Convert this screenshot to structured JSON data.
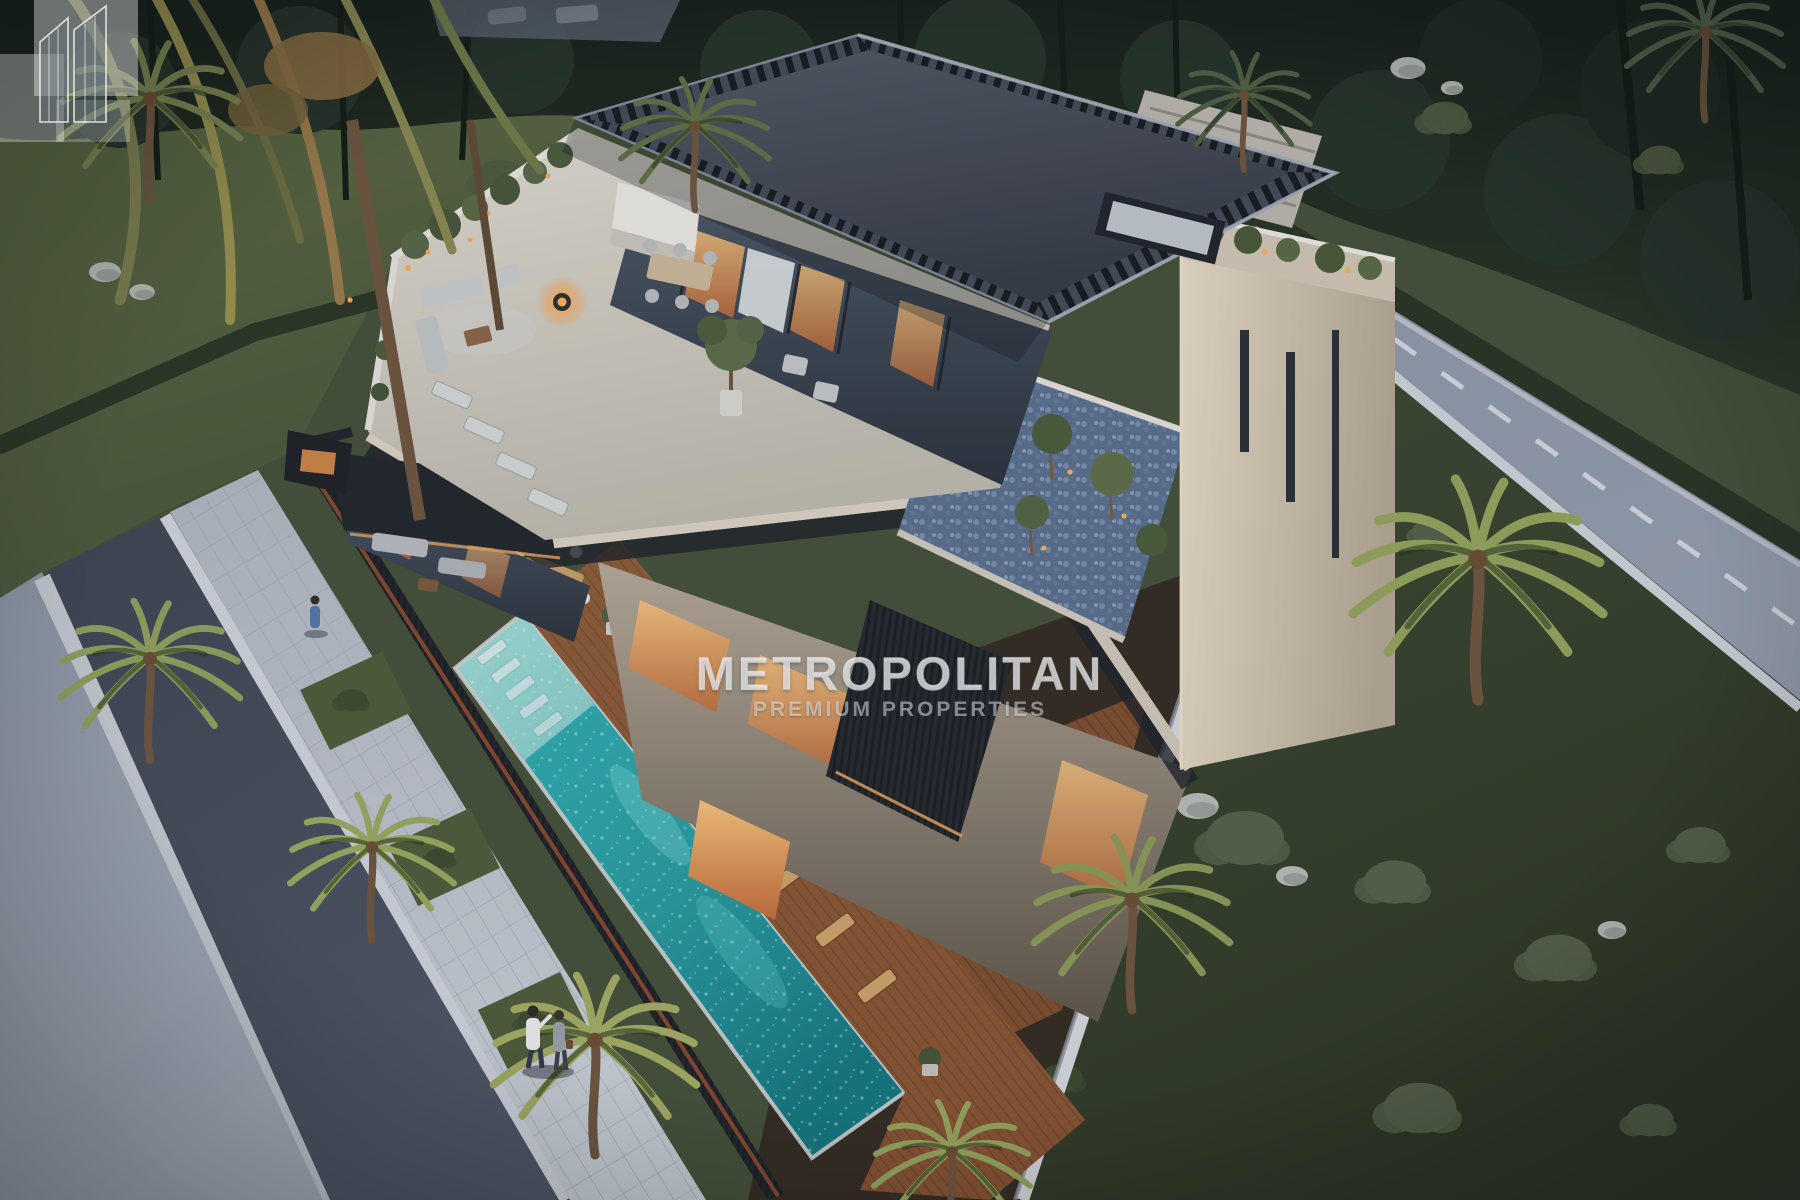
{
  "scene": {
    "type": "architectural-render",
    "description": "Aerial dusk view of a modern three-storey luxury villa: dark slatted flat roof, rooftop lounge terrace, warm-lit glass walls, travertine tower, blue-pebble roof gardens, long turquoise pool with sun-shelf loungers, timber deck, dark slat fence, palm trees, lawns and two perimeter roads with a couple walking on the sidewalk",
    "time_of_day": "dusk"
  },
  "watermark": {
    "logo": "metropolitan-buildings-mark",
    "title": "METROPOLITAN",
    "subtitle": "PREMIUM PROPERTIES"
  },
  "colors": {
    "pool": "#2aa7ab",
    "pool_shelf": "#a8dcd6",
    "roof": "#3e4551",
    "lawn": "#45513a",
    "road": "#8d97a8",
    "building": "#d9cec0",
    "glass_glow": "#e8a45f",
    "deck": "#7e4f31",
    "fence": "#23262c",
    "pebbles": "#5b6f8e",
    "watermark_text": "rgba(255,255,255,0.5)"
  }
}
